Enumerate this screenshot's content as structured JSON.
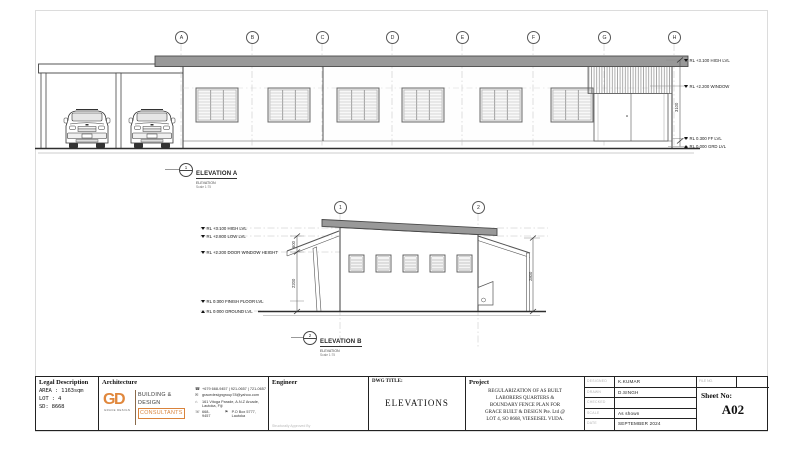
{
  "colors": {
    "roof_gray": "#999999",
    "accent_orange": "#E0873C"
  },
  "elevation_a": {
    "grid_bubbles": [
      "A",
      "B",
      "C",
      "D",
      "E",
      "F",
      "G",
      "H"
    ],
    "levels": {
      "high": "RL +3.100 HIGH LVL",
      "window": "RL +2.200 WINDOW",
      "ff": "RL 0.300 FF LVL",
      "grd": "RL 0.000 GRD LVL"
    },
    "dim_height": "3100",
    "marker_no": "1",
    "label_title": "ELEVATION A",
    "label_sub": "ELEVATION",
    "label_scale": "Scale 1:75"
  },
  "elevation_b": {
    "grid_bubbles": [
      "1",
      "2"
    ],
    "levels": {
      "high": "RL +3.100 HIGH LVL",
      "low": "RL +2.800 LOW LVL",
      "door": "RL +2.200 DOOR WINDOW HEIGHT",
      "ff": "RL 0.300 FINISH FLOOR LVL",
      "grd": "RL 0.000 GROUND LVL"
    },
    "dim_upper": "600",
    "dim_lower": "2200",
    "dim_right": "2800",
    "marker_no": "2",
    "label_title": "ELEVATION B",
    "label_sub": "ELEVATION",
    "label_scale": "Scale 1:75"
  },
  "title_block": {
    "legal": {
      "header": "Legal Description",
      "area": "AREA : 1163sqm",
      "lot": "LOT : 4",
      "sd": "SD: 8668"
    },
    "architecture": {
      "header": "Architecture",
      "logo_mark": "GD",
      "logo_sub": "GRACE DESIGN",
      "firm_line1": "BUILDING &",
      "firm_line2": "DESIGN",
      "firm_line3": "CONSULTANTS",
      "phone": "+679 668-9457 | 921-0657 | 721-0657",
      "email": "gracedesigngroup78@yahoo.com",
      "address1": "161 Vitoga Parade, A.N.Z Arcade,",
      "address2": "Lautoka, Fiji",
      "fax": "668-9457",
      "pobox": "P.O Box 5777, Lautoka"
    },
    "engineer": {
      "header": "Engineer",
      "approved": "Structurally Approved By"
    },
    "dwg": {
      "header": "DWG TITLE:",
      "title": "ELEVATIONS"
    },
    "project": {
      "header": "Project",
      "line1": "REGULARIZATION OF AS BUILT",
      "line2": "LABORERS QUARTERS &",
      "line3": "BOUNDARY FENCE PLAN FOR",
      "line4": "GRACE BUILT & DESIGN Pte. Ltd @",
      "line5": "LOT 4, SO 8668, VIESEISEL VUDA."
    },
    "meta": {
      "designed_label": "DESIGNED",
      "designed": "K.KUMAR",
      "drawn_label": "DRAWN",
      "drawn": "D.SINGH",
      "checked_label": "CHECKED",
      "checked": "",
      "scale_label": "SCALE",
      "scale": "As shown",
      "date_label": "DATE",
      "date": "SEPTEMBER 2024",
      "file_no_label": "FILE NO.",
      "sheet_label": "Sheet No:",
      "sheet_no": "A02"
    }
  }
}
